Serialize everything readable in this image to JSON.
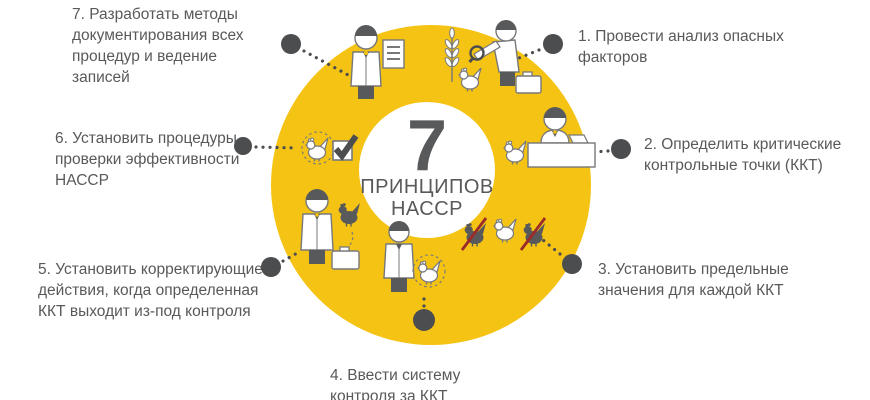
{
  "center": {
    "number": "7",
    "subtitle_line1": "ПРИНЦИПОВ",
    "subtitle_line2": "НАССР"
  },
  "principles": [
    {
      "id": "1",
      "text": "1. Провести анализ опасных факторов"
    },
    {
      "id": "2",
      "text": "2. Определить критические контрольные точки (ККТ)"
    },
    {
      "id": "3",
      "text": "3. Установить предельные значения для каждой ККТ"
    },
    {
      "id": "4",
      "text": "4. Ввести систему контроля за ККТ"
    },
    {
      "id": "5",
      "text": "5. Установить корректирующие действия, когда определенная ККТ выходит из-под контроля"
    },
    {
      "id": "6",
      "text": "6. Установить процедуры проверки эффективности НАССР"
    },
    {
      "id": "7",
      "text": "7. Разработать методы документирования всех процедур и ведение записей"
    }
  ],
  "icons": [
    {
      "name": "scientist-document-icon"
    },
    {
      "name": "inspector-magnifier-icon"
    },
    {
      "name": "registrar-desk-icon"
    },
    {
      "name": "rejected-chickens-icon"
    },
    {
      "name": "worker-chicken-icon"
    },
    {
      "name": "auditor-briefcase-icon"
    },
    {
      "name": "chicken-checkbox-icon"
    }
  ],
  "colors": {
    "ring": "#F5C313",
    "text": "#58595B",
    "dot": "#4C4D4F",
    "outline": "#77787B",
    "dark": "#58595B",
    "reject_red": "#9B2A2A",
    "white": "#FFFFFF"
  }
}
